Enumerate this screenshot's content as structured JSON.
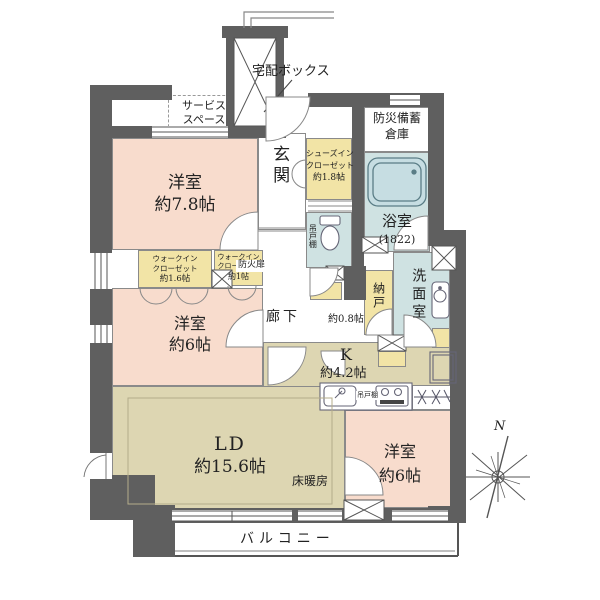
{
  "plan": {
    "type": "floorplan",
    "labels": {
      "delivery_box": "宅配ボックス",
      "service_space": {
        "line1": "サービス",
        "line2": "スペース"
      },
      "entrance": {
        "name": "玄関"
      },
      "shoes_closet": {
        "line1": "シューズイン",
        "line2": "クローゼット",
        "size": "約1.8帖"
      },
      "disaster_storage": {
        "line1": "防災備蓄",
        "line2": "倉庫"
      },
      "bedroom1": {
        "name": "洋室",
        "size": "約7.8帖"
      },
      "wic1": {
        "line1": "ウォークイン",
        "line2": "クローゼット",
        "size": "約1.6帖"
      },
      "wic2": {
        "line1": "ウォークイン",
        "line2": "クローゼット",
        "size": "約1帖"
      },
      "bedroom2": {
        "name": "洋室",
        "size": "約6帖"
      },
      "bath": {
        "name": "浴室",
        "size": "(1822)"
      },
      "toilet_shelf": "吊戸棚",
      "storage_room": {
        "name": "納戸"
      },
      "washroom": {
        "name": "洗面室"
      },
      "corridor": {
        "name": "廊下",
        "size": "約0.8帖"
      },
      "fire_door": "防火扉",
      "kitchen": {
        "name": "K",
        "size": "約4.2帖"
      },
      "kitchen_shelf": "吊戸棚",
      "living_dining": {
        "name": "LD",
        "size": "約15.6帖",
        "note": "床暖房"
      },
      "bedroom3": {
        "name": "洋室",
        "size": "約6帖"
      },
      "balcony": {
        "name": "バルコニー"
      },
      "compass_north": "N"
    },
    "colors": {
      "wall": "#5f5f5f",
      "bedroom": "#f8dccd",
      "living_kitchen": "#ddd6b2",
      "closet": "#f2e4a6",
      "wet_area": "#cfe2e2",
      "line": "#6b6b6b"
    }
  }
}
